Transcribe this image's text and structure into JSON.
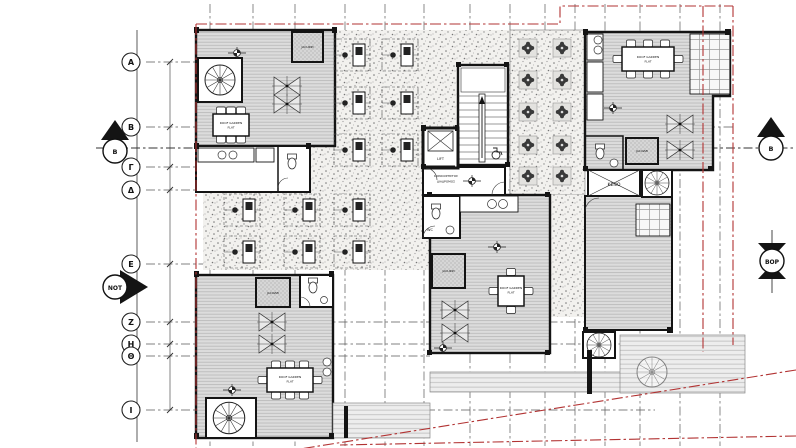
{
  "grid": {
    "rows": [
      {
        "label": "Α"
      },
      {
        "label": "Β"
      },
      {
        "label": "Γ"
      },
      {
        "label": "Δ"
      },
      {
        "label": "Ε"
      },
      {
        "label": "Ζ"
      },
      {
        "label": "Η"
      },
      {
        "label": "Θ"
      },
      {
        "label": "Ι"
      }
    ]
  },
  "markers": {
    "section_left": "Β",
    "section_right": "Β",
    "south_arrow": "ΝΟΤ",
    "north_arrow": "ΒΟΡ"
  },
  "labels": {
    "lift": "LIFT",
    "corridor_line1": "ΚΟΙΝΟΧΡΗΣΤΟΣ",
    "corridor_line2": "ΔΙΑΔΡΟΜΟΣ",
    "void": "ΚΕΝΟ",
    "wc": "WC",
    "jacuzzi": "JACUZZI",
    "roof_garden": "ROOF GARDEN",
    "flat": "FLAT"
  },
  "colors": {
    "boundary": "#b23333",
    "wall": "#141414",
    "deck": "#dcdcdc",
    "stipple_bg": "#f2f1ee",
    "grid_line": "#555555"
  }
}
